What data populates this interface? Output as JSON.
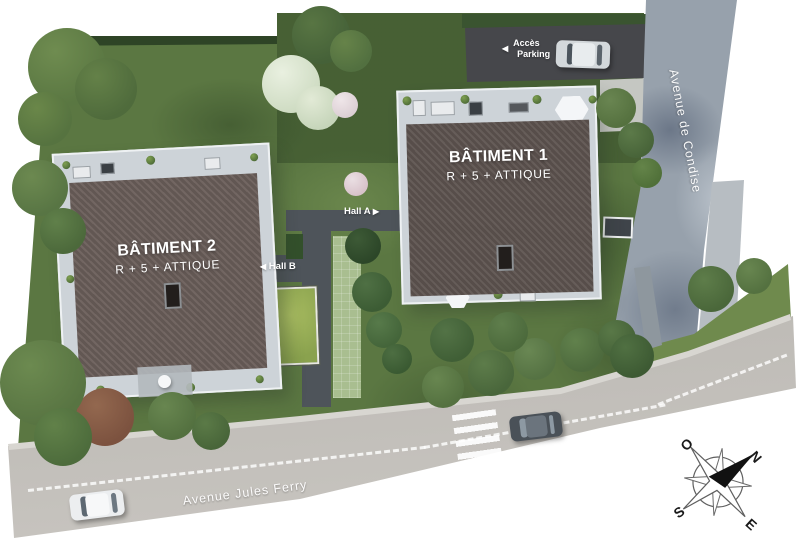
{
  "buildings": {
    "batiment1": {
      "title": "BÂTIMENT 1",
      "subtitle": "R + 5 + ATTIQUE"
    },
    "batiment2": {
      "title": "BÂTIMENT 2",
      "subtitle": "R + 5 + ATTIQUE"
    }
  },
  "halls": {
    "hall_a": "Hall A",
    "hall_b": "Hall B",
    "arrow_right": "▶",
    "arrow_left": "◀"
  },
  "parking": {
    "arrow": "◀",
    "line1": "Accès",
    "line2": "Parking"
  },
  "streets": {
    "bottom": "Avenue Jules Ferry",
    "right": "Avenue de Condise"
  },
  "compass": {
    "north": "N",
    "south": "S",
    "east": "E",
    "west": "O"
  },
  "colors": {
    "lawn": "#5b7742",
    "roof_dark": "#5e5450",
    "deck_gray": "#cdd3d8",
    "parking_asphalt": "#46474b",
    "road_right": "#97a1ac",
    "road_bottom": "#bcb9b4",
    "path_dark": "#4e545a",
    "label_text": "#ffffff"
  }
}
